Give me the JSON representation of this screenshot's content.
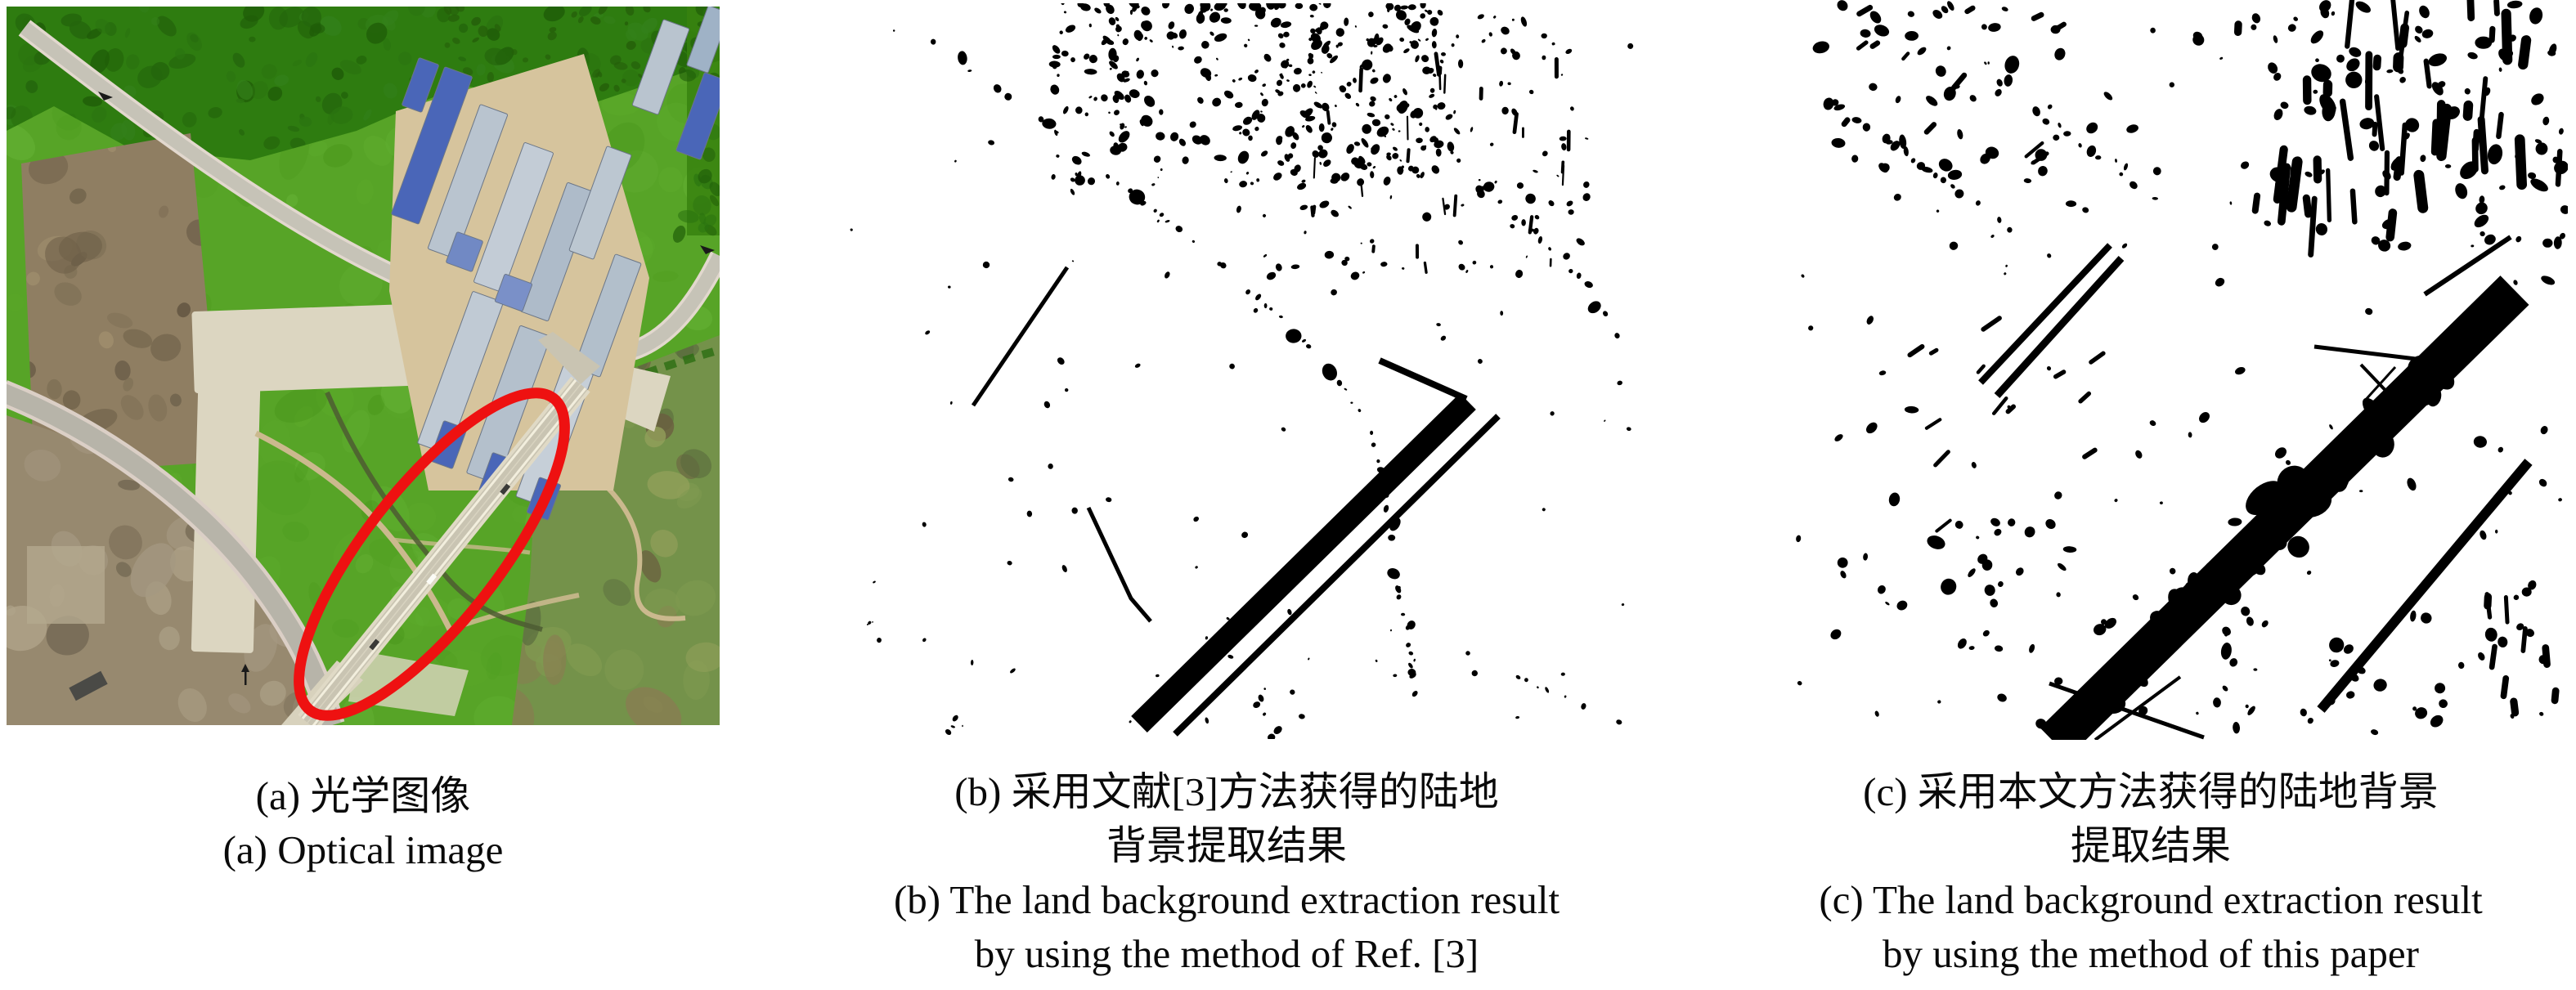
{
  "figure": {
    "panels": [
      {
        "id": "a",
        "type": "optical-image",
        "caption_lines": [
          "(a) 光学图像",
          "(a) Optical image"
        ]
      },
      {
        "id": "b",
        "type": "binary-extraction-result",
        "caption_lines": [
          "(b) 采用文献[3]方法获得的陆地",
          "背景提取结果",
          "(b) The land background extraction result",
          "by using the method of Ref. [3]"
        ]
      },
      {
        "id": "c",
        "type": "binary-extraction-result",
        "caption_lines": [
          "(c) 采用本文方法获得的陆地背景",
          "提取结果",
          "(c) The land background extraction result",
          "by using the method of this paper"
        ]
      }
    ],
    "colors": {
      "page_background": "#ffffff",
      "binary_foreground": "#000000",
      "binary_background": "#ffffff",
      "highlight_ellipse": "#ee1111",
      "caption_text": "#0a0a0a",
      "grass": "#57a427",
      "forest": "#2e7c10",
      "bare_field": "#8f7e62",
      "construction_dirt": "#97896f",
      "wetland": "#74924a",
      "concrete_pad": "#dcd6c1",
      "road": "#c6c3b7",
      "bridge_deck": "#c9c4b2",
      "roof_dark_blue": "#4a66b8",
      "roof_light_blue": "#b9c4cf"
    }
  }
}
